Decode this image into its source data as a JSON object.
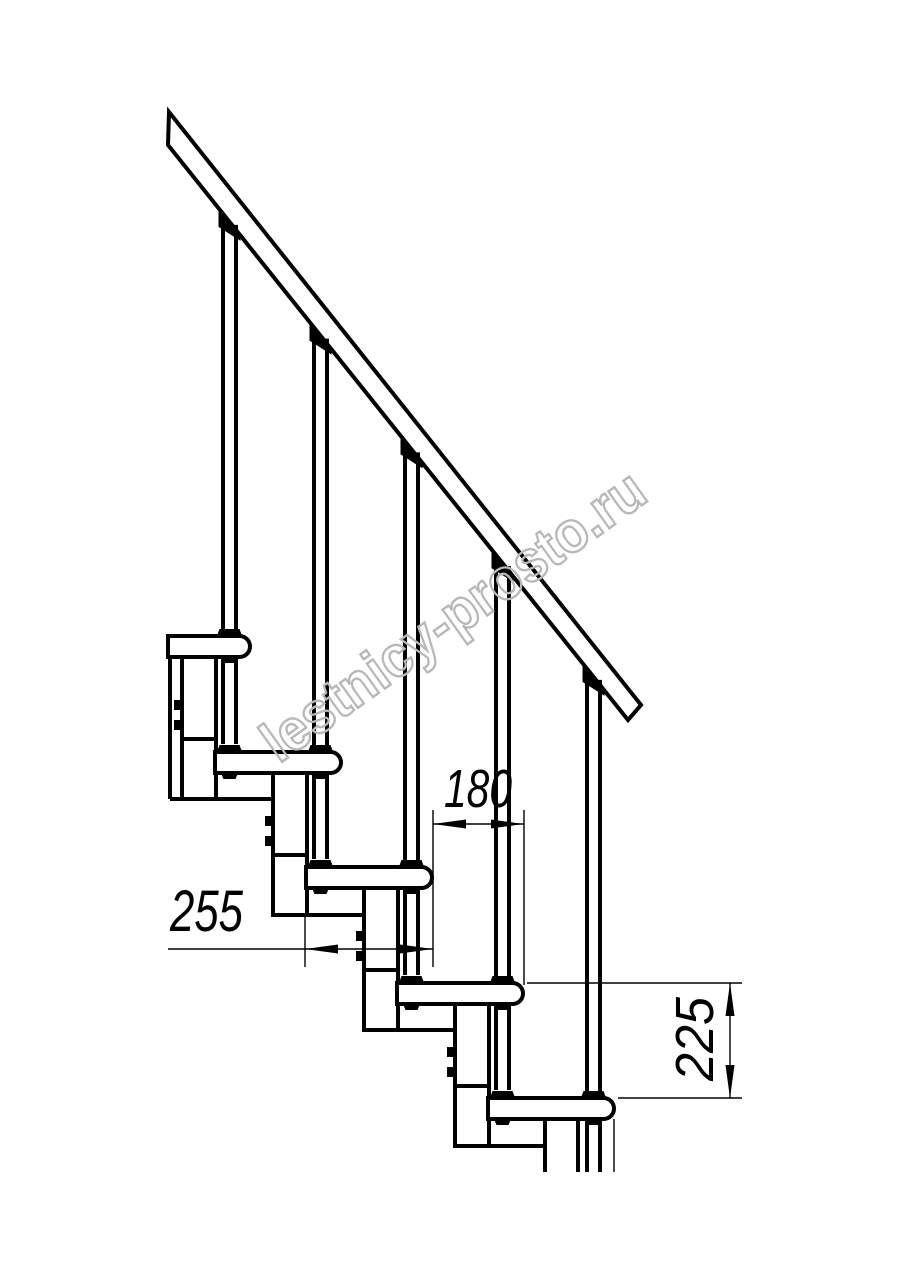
{
  "drawing": {
    "type": "staircase-side-view-technical-drawing",
    "steps_visible": 5,
    "balusters_visible": 5,
    "dimensions": {
      "tread_length": "255",
      "step_run": "180",
      "step_rise": "225"
    },
    "watermark": "lestnicy-prosto.ru",
    "colors": {
      "line": "#000000",
      "watermark_outline": "#b8b8b8",
      "background": "#ffffff"
    }
  }
}
